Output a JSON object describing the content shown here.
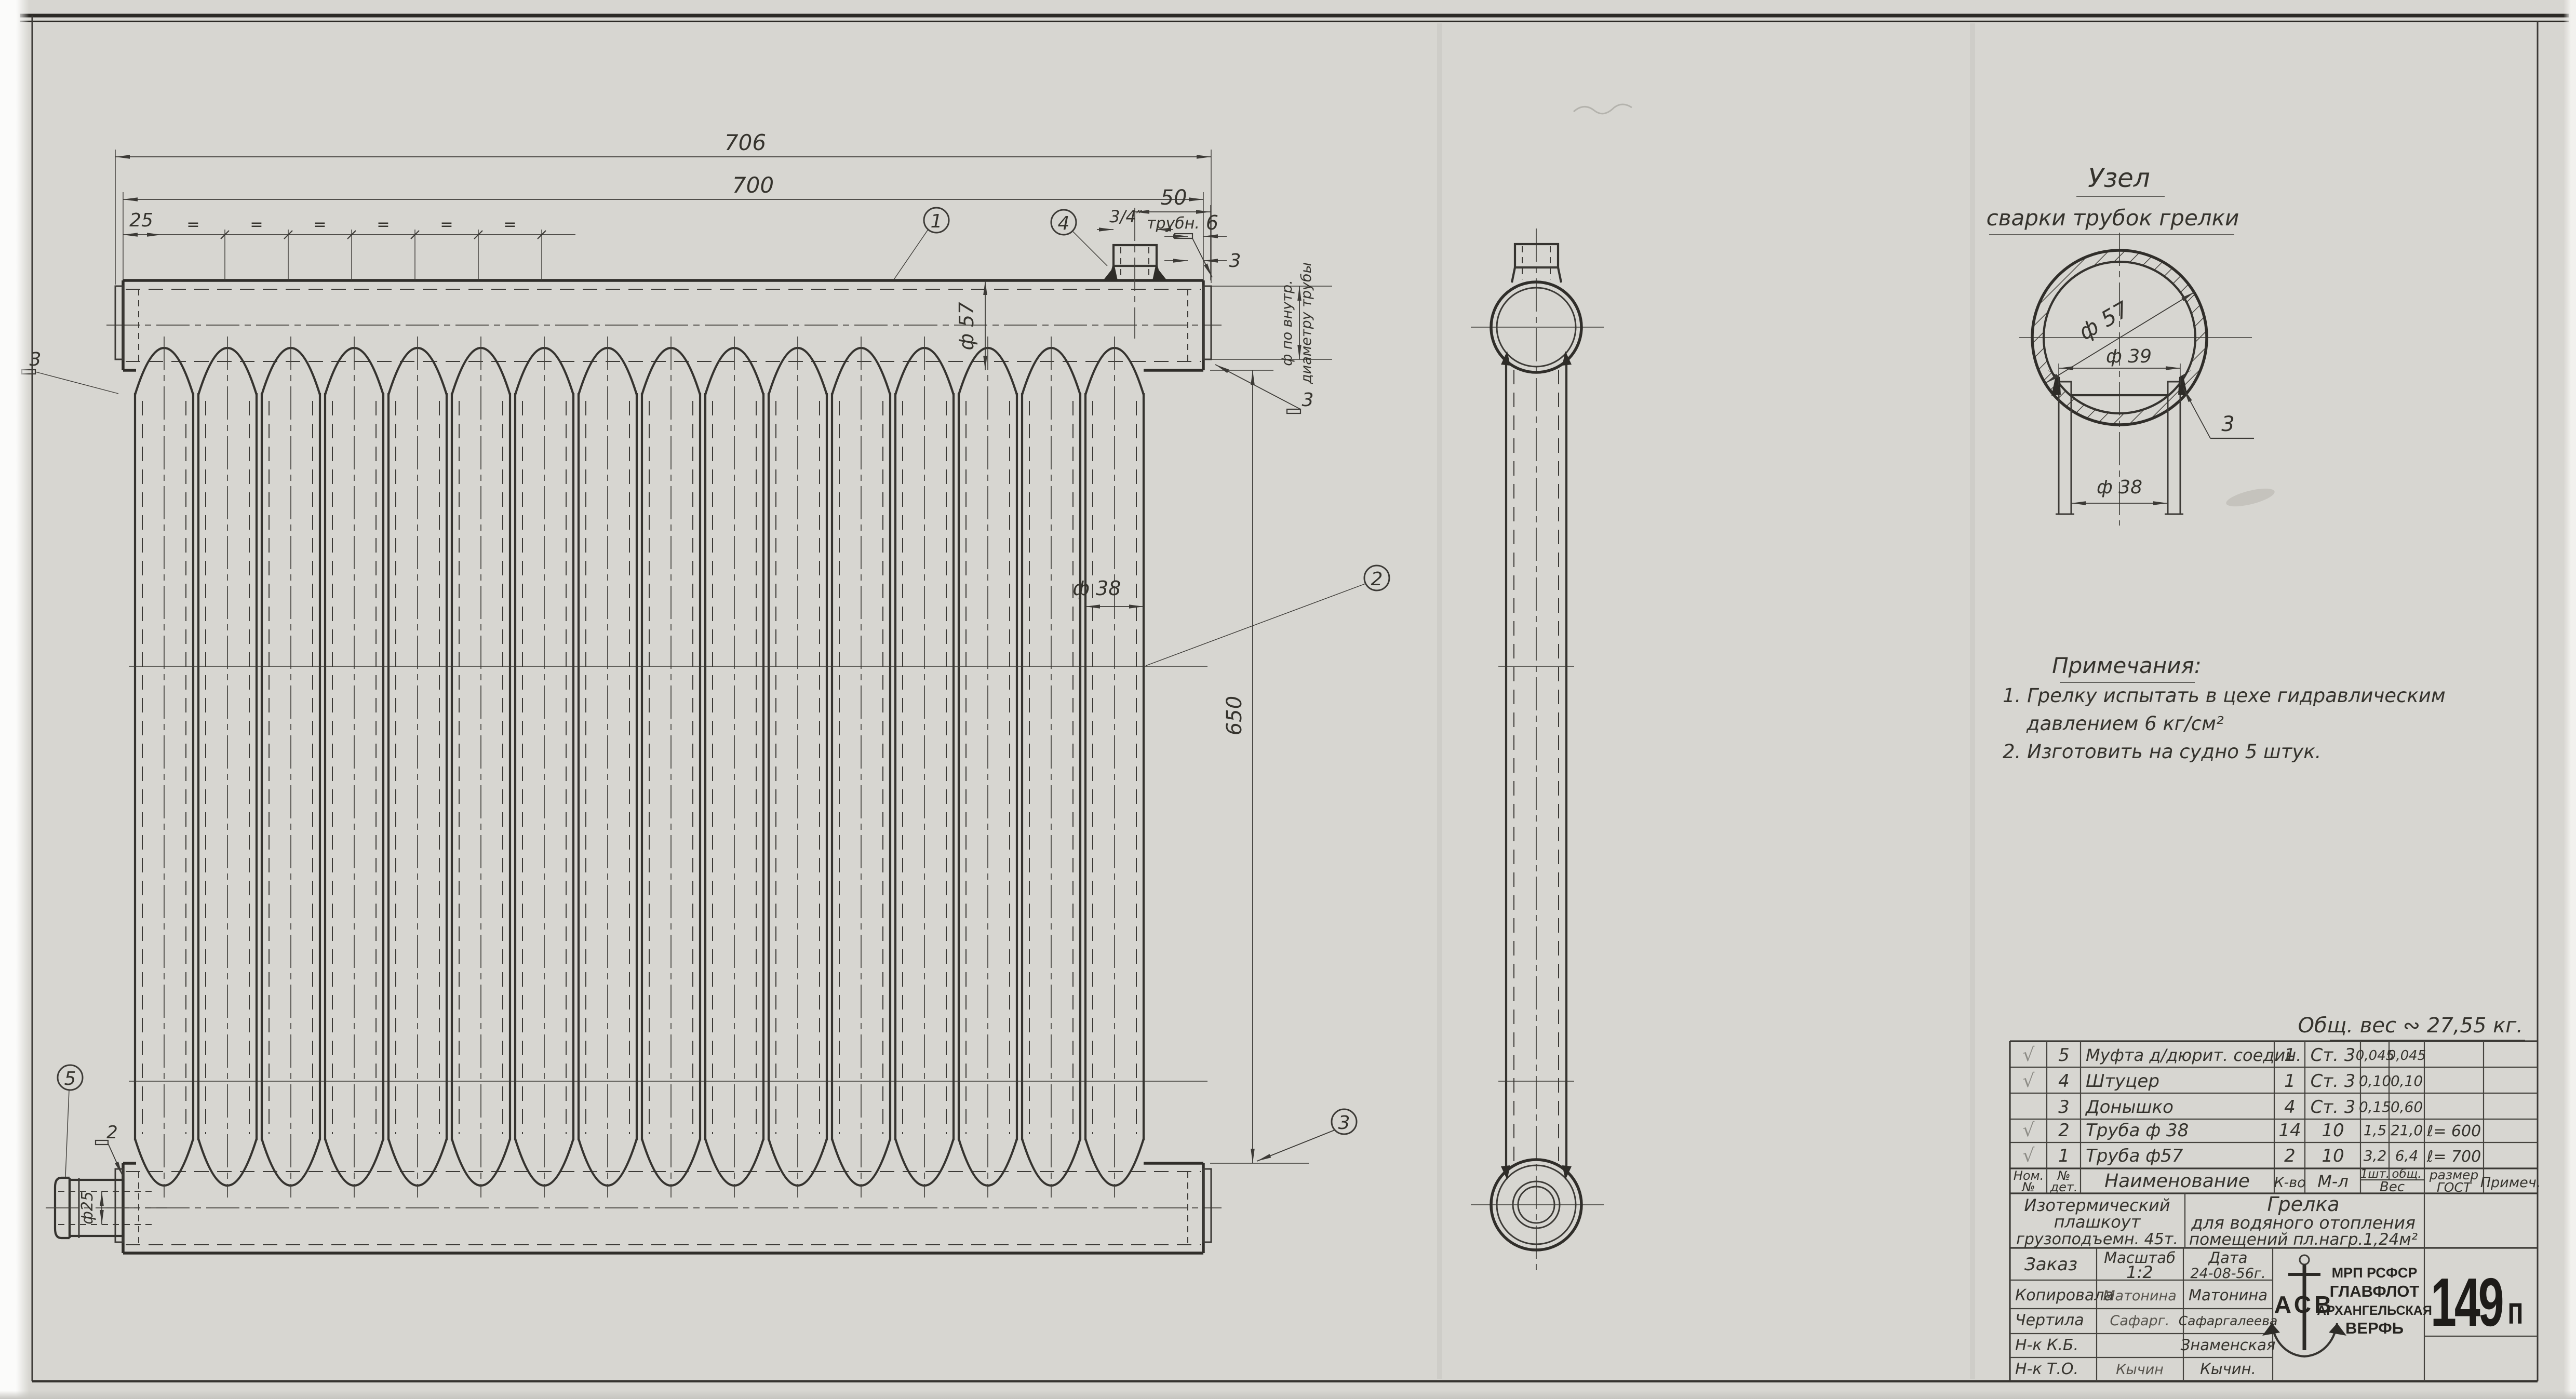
{
  "dims": {
    "w706": "706",
    "w700": "700",
    "p25": "25",
    "eq": "=",
    "d57": "ф 57",
    "d38": "ф 38",
    "len650": "650",
    "fit50": "50",
    "thread": "3/4″",
    "threadUnit": "трубн.",
    "cap6": "6",
    "wall3": "3",
    "weldL": "3",
    "weldR": "3",
    "weldB2": "2",
    "d25": "ф25",
    "vnote1": "ф по внутр.",
    "vnote2": "диаметру трубы"
  },
  "callouts": {
    "c1": "1",
    "c2": "2",
    "c3": "3",
    "c4": "4",
    "c5": "5"
  },
  "detail": {
    "t1": "Узел",
    "t2": "сварки трубок грелки",
    "d57": "ф 57",
    "d39": "ф 39",
    "d38": "ф 38",
    "weld": "3"
  },
  "notes": {
    "title": "Примечания:",
    "l1": "1. Грелку испытать в цехе гидравлическим",
    "l2": "давлением 6 кг/см²",
    "l3": "2. Изготовить на судно 5 штук."
  },
  "weight": "Общ. вес ∾ 27,55 кг.",
  "table": {
    "h": {
      "nom1": "Ном.",
      "nom2": "№",
      "det1": "№",
      "det2": "дет.",
      "name": "Наименование",
      "qty": "К-во",
      "mat": "М-л",
      "w1": "1шт.",
      "w2": "общ.",
      "wes": "Вес",
      "size1": "размер",
      "size2": "ГОСТ",
      "note": "Примеч."
    },
    "rows": [
      {
        "chk": "√",
        "no": "5",
        "name": "Муфта д/дюрит. соедин.",
        "qty": "1",
        "mat": "Ст. 3",
        "w1": "0,045",
        "w2": "0,045",
        "size": ""
      },
      {
        "chk": "√",
        "no": "4",
        "name": "Штуцер",
        "qty": "1",
        "mat": "Ст. 3",
        "w1": "0,10",
        "w2": "0,10",
        "size": ""
      },
      {
        "chk": "",
        "no": "3",
        "name": "Донышко",
        "qty": "4",
        "mat": "Ст. 3",
        "w1": "0,15",
        "w2": "0,60",
        "size": ""
      },
      {
        "chk": "√",
        "no": "2",
        "name": "Труба ф 38",
        "qty": "14",
        "mat": "10",
        "w1": "1,5",
        "w2": "21,0",
        "size": "ℓ= 600"
      },
      {
        "chk": "√",
        "no": "1",
        "name": "Труба ф57",
        "qty": "2",
        "mat": "10",
        "w1": "3,2",
        "w2": "6,4",
        "size": "ℓ= 700"
      }
    ]
  },
  "tb": {
    "project1": "Изотермический",
    "project2": "плашкоут",
    "project3": "грузоподъемн. 45т.",
    "title1": "Грелка",
    "title2": "для водяного отопления",
    "title3": "помещений пл.нагр.1,24м²",
    "order": "Заказ",
    "scaleL": "Масштаб",
    "scaleV": "1:2",
    "dateL": "Дата",
    "dateV": "24-08-56г.",
    "r1l": "Копировала",
    "r1s": "Матонина",
    "r1n": "Матонина",
    "r2l": "Чертила",
    "r2s": "Сафарг.",
    "r2n": "Сафаргалеева",
    "r3l": "Н-к К.Б.",
    "r3s": "",
    "r3n": "Знаменская",
    "r4l": "Н-к Т.О.",
    "r4s": "Кычин",
    "r4n": "Кычин."
  },
  "org": {
    "logo": "АСВ",
    "l1": "МРП РСФСР",
    "l2": "ГЛАВФЛОТ",
    "l3": "АРХАНГЕЛЬСКАЯ",
    "l4": "ВЕРФЬ"
  },
  "stamp": {
    "n": "149",
    "suffix": "п"
  }
}
